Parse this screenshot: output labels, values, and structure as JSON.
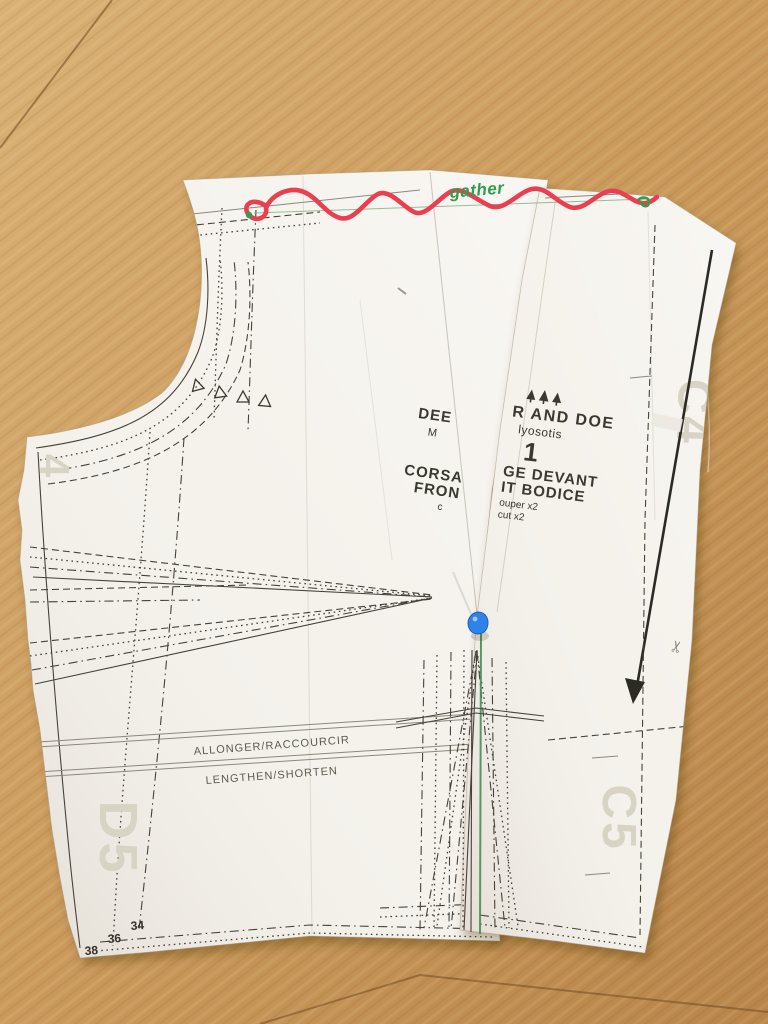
{
  "annotations": {
    "gather": "gather"
  },
  "left_piece": {
    "partial_text": {
      "line1": "DEE",
      "line2": "M",
      "line3": "CORSA",
      "line4": "FRON",
      "line5": "c"
    },
    "lengthen_fr": "ALLONGER/RACCOURCIR",
    "lengthen_en": "LENGTHEN/SHORTEN",
    "sizes": {
      "s38": "38",
      "s36": "36",
      "s34": "34"
    },
    "label_d5": "D5",
    "label_4": "4"
  },
  "right_piece": {
    "brand": "R AND DOE",
    "pattern_name": "lyosotis",
    "piece_number": "1",
    "name_fr": "GE DEVANT",
    "name_en": "IT BODICE",
    "cut_fr": "ouper x2",
    "cut_en": "cut x2",
    "label_c4": "C4",
    "label_c5": "C5"
  },
  "icons": {
    "scissors": "✂"
  },
  "colors": {
    "floor_wood": "#c99a5c",
    "paper": "#f5f2ec",
    "marker_red": "#ea3f50",
    "marker_green": "#2f9e4e",
    "print_dark": "#3a382f",
    "print_ghost_gray": "#d7d3c5",
    "pin_blue": "#2f82e8"
  }
}
